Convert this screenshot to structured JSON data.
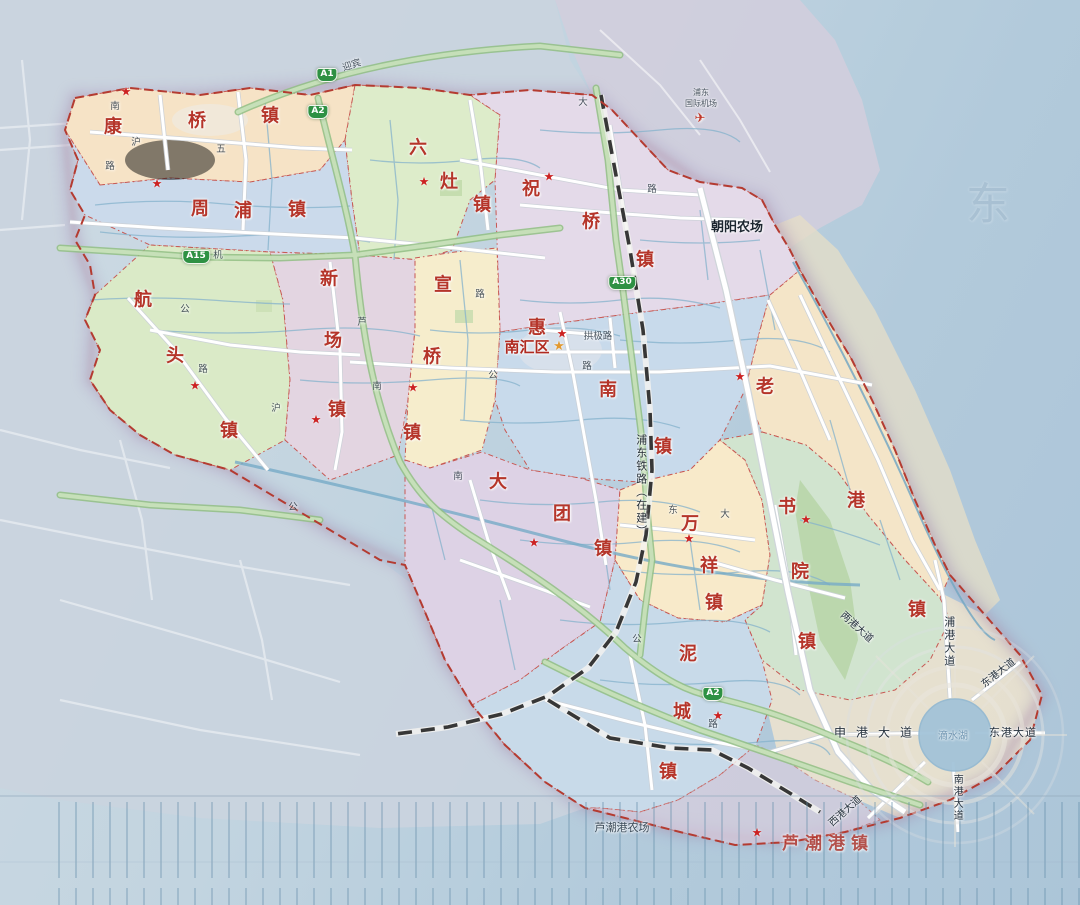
{
  "palette": {
    "town_label": "#b5352a",
    "district_label": "#b02a20",
    "boundary_red": "#b03126",
    "seat_star": "#cc2222",
    "capital_star": "#e2992f",
    "shield_green": "#2e9143",
    "road_text": "#2e3a46",
    "water_text": "#5e86a5",
    "sea": "#aec8da",
    "railway": "#2d2d2d"
  },
  "district": {
    "name": "南汇区",
    "x": 527,
    "y": 348,
    "star_x": 559,
    "star_y": 347
  },
  "towns": [
    {
      "id": "kangqiao",
      "name": "康桥镇",
      "chars": [
        {
          "c": "康",
          "x": 113,
          "y": 128
        },
        {
          "c": "桥",
          "x": 197,
          "y": 122
        },
        {
          "c": "镇",
          "x": 270,
          "y": 117
        }
      ]
    },
    {
      "id": "zhoupu",
      "name": "周浦镇",
      "chars": [
        {
          "c": "周",
          "x": 200,
          "y": 210
        },
        {
          "c": "浦",
          "x": 243,
          "y": 212
        },
        {
          "c": "镇",
          "x": 297,
          "y": 211
        }
      ]
    },
    {
      "id": "hangtou",
      "name": "航头镇",
      "chars": [
        {
          "c": "航",
          "x": 143,
          "y": 301
        },
        {
          "c": "头",
          "x": 175,
          "y": 357
        },
        {
          "c": "镇",
          "x": 229,
          "y": 432
        }
      ]
    },
    {
      "id": "xinchang",
      "name": "新场镇",
      "chars": [
        {
          "c": "新",
          "x": 329,
          "y": 280
        },
        {
          "c": "场",
          "x": 333,
          "y": 342
        },
        {
          "c": "镇",
          "x": 337,
          "y": 411
        }
      ]
    },
    {
      "id": "liuzao",
      "name": "六灶镇",
      "chars": [
        {
          "c": "六",
          "x": 418,
          "y": 149
        },
        {
          "c": "灶",
          "x": 449,
          "y": 183
        },
        {
          "c": "镇",
          "x": 482,
          "y": 206
        }
      ]
    },
    {
      "id": "xuanqiao",
      "name": "宣桥镇",
      "chars": [
        {
          "c": "宣",
          "x": 443,
          "y": 286
        },
        {
          "c": "桥",
          "x": 432,
          "y": 358
        },
        {
          "c": "镇",
          "x": 412,
          "y": 434
        }
      ]
    },
    {
      "id": "zhuqiao",
      "name": "祝桥镇",
      "chars": [
        {
          "c": "祝",
          "x": 531,
          "y": 190
        },
        {
          "c": "桥",
          "x": 591,
          "y": 223
        },
        {
          "c": "镇",
          "x": 645,
          "y": 261
        }
      ]
    },
    {
      "id": "huinan",
      "name": "惠南镇",
      "chars": [
        {
          "c": "惠",
          "x": 537,
          "y": 329
        },
        {
          "c": "南",
          "x": 608,
          "y": 391
        },
        {
          "c": "镇",
          "x": 663,
          "y": 448
        }
      ]
    },
    {
      "id": "datuan",
      "name": "大团镇",
      "chars": [
        {
          "c": "大",
          "x": 498,
          "y": 483
        },
        {
          "c": "团",
          "x": 562,
          "y": 515
        },
        {
          "c": "镇",
          "x": 603,
          "y": 550
        }
      ]
    },
    {
      "id": "laogang",
      "name": "老港镇",
      "chars": [
        {
          "c": "老",
          "x": 765,
          "y": 388
        },
        {
          "c": "港",
          "x": 856,
          "y": 502
        },
        {
          "c": "镇",
          "x": 917,
          "y": 611
        }
      ]
    },
    {
      "id": "wanxiang",
      "name": "万祥镇",
      "chars": [
        {
          "c": "万",
          "x": 690,
          "y": 525
        },
        {
          "c": "祥",
          "x": 709,
          "y": 567
        },
        {
          "c": "镇",
          "x": 714,
          "y": 604
        }
      ]
    },
    {
      "id": "shuyuan",
      "name": "书院镇",
      "chars": [
        {
          "c": "书",
          "x": 787,
          "y": 508
        },
        {
          "c": "院",
          "x": 800,
          "y": 573
        },
        {
          "c": "镇",
          "x": 807,
          "y": 643
        }
      ]
    },
    {
      "id": "nicheng",
      "name": "泥城镇",
      "chars": [
        {
          "c": "泥",
          "x": 688,
          "y": 655
        },
        {
          "c": "城",
          "x": 682,
          "y": 713
        },
        {
          "c": "镇",
          "x": 668,
          "y": 773
        }
      ]
    },
    {
      "id": "luchaogang",
      "name": "芦潮港镇",
      "text": "芦潮港镇",
      "x": 828,
      "y": 845,
      "spacing": 6
    }
  ],
  "town_seats": [
    {
      "x": 126,
      "y": 92
    },
    {
      "x": 157,
      "y": 184
    },
    {
      "x": 424,
      "y": 182
    },
    {
      "x": 549,
      "y": 177
    },
    {
      "x": 562,
      "y": 334
    },
    {
      "x": 195,
      "y": 386
    },
    {
      "x": 316,
      "y": 420
    },
    {
      "x": 413,
      "y": 388
    },
    {
      "x": 534,
      "y": 543
    },
    {
      "x": 689,
      "y": 539
    },
    {
      "x": 718,
      "y": 716
    },
    {
      "x": 806,
      "y": 520
    },
    {
      "x": 740,
      "y": 377
    },
    {
      "x": 757,
      "y": 833
    }
  ],
  "highway_shields": [
    {
      "label": "A1",
      "x": 327,
      "y": 75
    },
    {
      "label": "A2",
      "x": 318,
      "y": 112
    },
    {
      "label": "A15",
      "x": 196,
      "y": 257
    },
    {
      "label": "A30",
      "x": 622,
      "y": 283
    },
    {
      "label": "A2",
      "x": 713,
      "y": 694
    }
  ],
  "places": [
    {
      "id": "chaoyang-farm",
      "text": "朝阳农场",
      "x": 737,
      "y": 228,
      "size": 13,
      "color": "#1c2630",
      "weight": "bold"
    },
    {
      "id": "luchaogang-farm",
      "text": "芦潮港农场",
      "x": 622,
      "y": 828,
      "size": 11,
      "color": "#3a4a58",
      "weight": "normal"
    }
  ],
  "airport": {
    "line1": "浦东",
    "line2": "国际机场",
    "x": 701,
    "y": 93,
    "icon": "✈",
    "icon_x": 700,
    "icon_y": 119
  },
  "railway_label": {
    "text": "浦东铁路（在建）",
    "x": 641,
    "y": 486,
    "size": 11
  },
  "avenues": [
    {
      "text": "申港大道",
      "x": 878,
      "y": 733,
      "size": 12,
      "spacing": 10
    },
    {
      "text": "东港大道",
      "x": 1013,
      "y": 733,
      "size": 11,
      "spacing": 1
    },
    {
      "text": "东港大道",
      "x": 999,
      "y": 674,
      "size": 10,
      "rotate": -38
    },
    {
      "text": "南港大道",
      "x": 956,
      "y": 798,
      "size": 10,
      "vertical": true
    },
    {
      "text": "浦港大道",
      "x": 949,
      "y": 642,
      "size": 11,
      "vertical": true
    },
    {
      "text": "西港大道",
      "x": 846,
      "y": 812,
      "size": 10,
      "rotate": -42
    },
    {
      "text": "两港大道",
      "x": 856,
      "y": 628,
      "size": 10,
      "rotate": 42
    }
  ],
  "lake": {
    "name": "滴水湖",
    "x": 953,
    "y": 737,
    "size": 10
  },
  "sea_ghost": {
    "text": "东",
    "x": 988,
    "y": 205,
    "size": 44
  },
  "road_fragments": [
    {
      "t": "迎宾",
      "x": 352,
      "y": 66,
      "r": -18
    },
    {
      "t": "南",
      "x": 115,
      "y": 107
    },
    {
      "t": "沪",
      "x": 136,
      "y": 143
    },
    {
      "t": "路",
      "x": 110,
      "y": 167
    },
    {
      "t": "五",
      "x": 221,
      "y": 150
    },
    {
      "t": "机",
      "x": 218,
      "y": 256
    },
    {
      "t": "公",
      "x": 185,
      "y": 310
    },
    {
      "t": "路",
      "x": 203,
      "y": 370
    },
    {
      "t": "芦",
      "x": 362,
      "y": 323
    },
    {
      "t": "沪",
      "x": 276,
      "y": 409
    },
    {
      "t": "南",
      "x": 377,
      "y": 387
    },
    {
      "t": "公",
      "x": 293,
      "y": 508
    },
    {
      "t": "路",
      "x": 480,
      "y": 295
    },
    {
      "t": "公",
      "x": 493,
      "y": 376
    },
    {
      "t": "路",
      "x": 587,
      "y": 367
    },
    {
      "t": "拱极路",
      "x": 598,
      "y": 337
    },
    {
      "t": "大",
      "x": 583,
      "y": 103
    },
    {
      "t": "路",
      "x": 652,
      "y": 190
    },
    {
      "t": "南",
      "x": 458,
      "y": 477
    },
    {
      "t": "东",
      "x": 673,
      "y": 511
    },
    {
      "t": "大",
      "x": 725,
      "y": 515
    },
    {
      "t": "公",
      "x": 637,
      "y": 640
    },
    {
      "t": "路",
      "x": 713,
      "y": 725
    }
  ]
}
